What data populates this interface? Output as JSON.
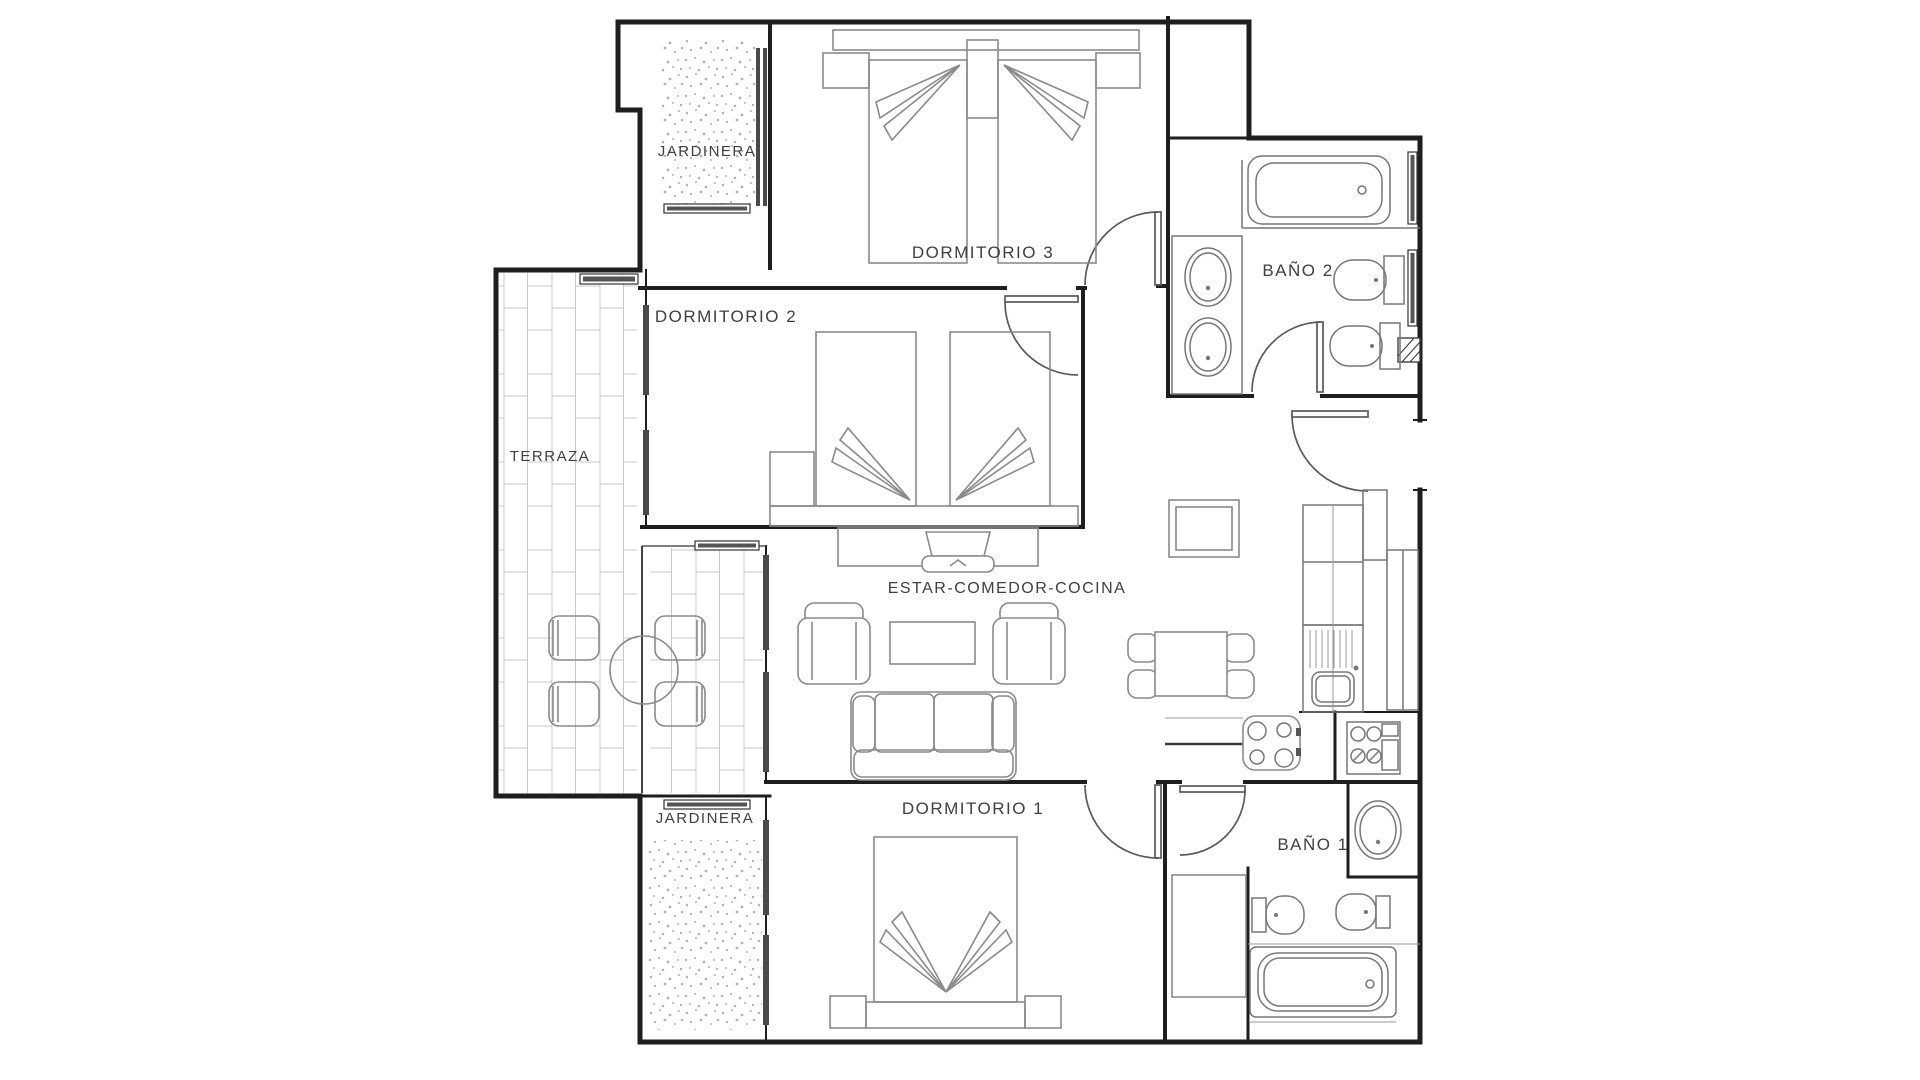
{
  "plan": {
    "title": "Apartment floor plan",
    "rooms": {
      "jardinera_top": "JARDINERA",
      "dormitorio3": "DORMITORIO 3",
      "bano2": "BAÑO 2",
      "dormitorio2": "DORMITORIO 2",
      "terraza": "TERRAZA",
      "estar": "ESTAR-COMEDOR-COCINA",
      "dormitorio1": "DORMITORIO 1",
      "jardinera_bottom": "JARDINERA",
      "bano1": "BAÑO 1"
    },
    "colors": {
      "wall": "#1e1e1e",
      "furniture": "#8a8a8a",
      "label": "#3f3f3f",
      "brick": "#c9c9c9",
      "stipple": "#b3b3b3",
      "background": "#ffffff"
    }
  }
}
